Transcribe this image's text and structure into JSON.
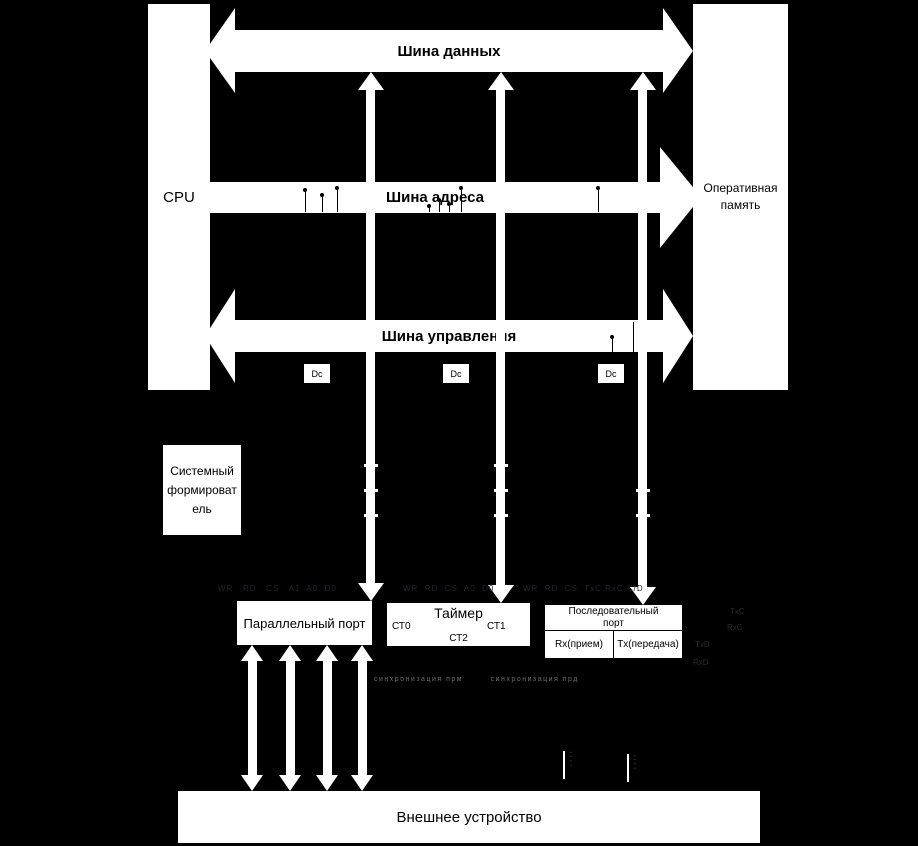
{
  "buses": {
    "data_label": "Шина данных",
    "address_label": "Шина адреса",
    "control_label": "Шина управления"
  },
  "blocks": {
    "cpu": "CPU",
    "ram_line1": "Оперативная",
    "ram_line2": "память",
    "former_lines": [
      "Системный",
      "формироват",
      "ель"
    ],
    "parallel": "Параллельный порт",
    "timer": "Таймер",
    "ct0": "СТ0",
    "ct1": "СТ1",
    "ct2": "СТ2",
    "serial_line1": "Последовательный",
    "serial_line2": "порт",
    "rx": "Rx(прием)",
    "tx": "Tx(передача)",
    "external": "Внешнее устройство"
  },
  "decoder": {
    "label": "Dc"
  },
  "pins": {
    "parallel": "WR   RD   CS   A1  A0  D0",
    "timer": "WR  RD  CS  A0  D0",
    "serial": "WR  RD  CS  TxC RxC C/D",
    "side": [
      "TxC",
      "RxC",
      "TxD",
      "RxD"
    ],
    "sync": "синхронизация прм        синхронизация прд"
  },
  "connector_dots": "····",
  "colors": {
    "background": "#000000",
    "block_fill": "#ffffff",
    "text": "#000000",
    "faint_pin_text": "#23232d",
    "sync_text": "#6e6e6e"
  }
}
